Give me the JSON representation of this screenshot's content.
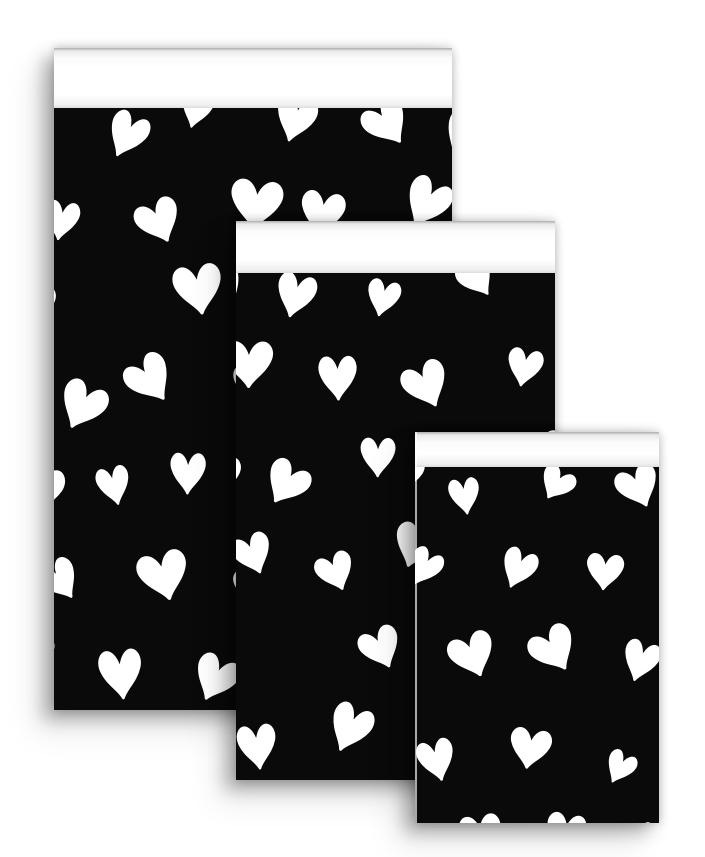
{
  "scene": {
    "background_color": "#ffffff"
  },
  "colors": {
    "bag_black": "#0a0a0a",
    "heart_white": "#ffffff",
    "flap_white": "#ffffff",
    "flap_top_shade": "#adadad",
    "flap_bottom_shade": "#dcdcdc",
    "shadow": "rgba(0,0,0,0.28)",
    "paper_edge_highlight": "rgba(255,255,255,0.65)"
  },
  "pattern": {
    "name": "hand-drawn-hearts",
    "heart_color": "#ffffff",
    "cell_width": 86,
    "cell_height": 90,
    "jitter": 15,
    "rotation_max_deg": 35,
    "skip_chance": 0.06,
    "start_x": -24,
    "start_y": 16
  },
  "bags": [
    {
      "id": "large",
      "seed": 7,
      "heart_min": 42,
      "heart_max": 58
    },
    {
      "id": "medium",
      "seed": 19,
      "heart_min": 40,
      "heart_max": 54
    },
    {
      "id": "small",
      "seed": 31,
      "heart_min": 36,
      "heart_max": 50
    }
  ]
}
